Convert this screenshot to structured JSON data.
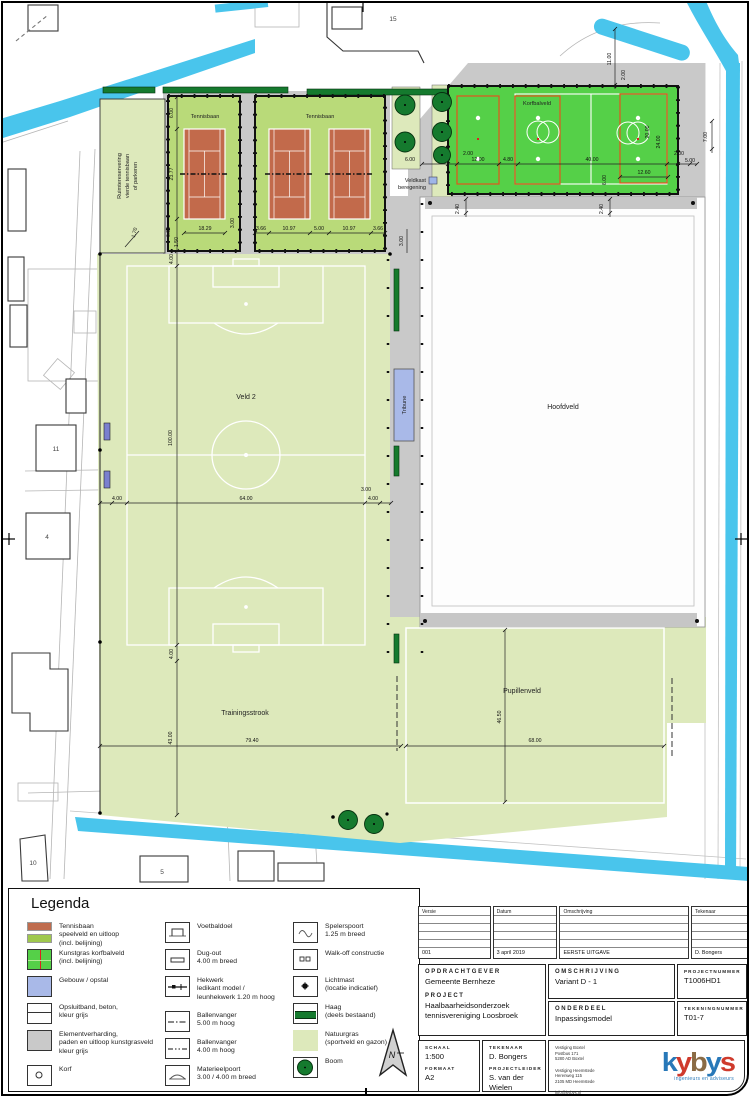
{
  "colors": {
    "water": "#49c5ec",
    "natuurgras": "#dde9bb",
    "kunstgras": "#55d048",
    "tennis_court": "#c26a4b",
    "tennis_uitloop": "#b9da79",
    "gebouw": "#a9b9e8",
    "verharding": "#c9c9c9",
    "haag": "#157a2e",
    "logo_blue": "#2878b8",
    "logo_red": "#cf3a2c",
    "logo_brown": "#8a6b45"
  },
  "plan": {
    "labels": {
      "tennis1": "Tennisbaan",
      "tennis2": "Tennisbaan",
      "korfbal": "Korfbalveld",
      "veld2": "Veld 2",
      "hoofdveld": "Hoofdveld",
      "training": "Trainingsstrook",
      "pupillen": "Pupillenveld",
      "tribune": "Tribune",
      "veldkast1": "Veldkast",
      "veldkast2": "beregening",
      "reserve1": "Ruimtereservering",
      "reserve2": "vierde tennisbaan",
      "reserve3": "of parkeren",
      "p15": "15",
      "p11": "11",
      "p4": "4",
      "p10": "10",
      "p5": "5"
    },
    "dims": {
      "t_top6": "6.00",
      "t_h": "23.77",
      "t_b6": "6.00",
      "t_150": "1.50",
      "t_300": "3.00",
      "t_w1": "18.29",
      "t_366a": "3.66",
      "t_1097a": "10.97",
      "t_500": "5.00",
      "t_1097b": "10.97",
      "t_366b": "3.66",
      "t_170": "1.70",
      "v_top4": "4.00",
      "v_100": "100.00",
      "v_bot4": "4.00",
      "v_l4": "4.00",
      "v_64": "64.00",
      "v_r4": "4.00",
      "v_300": "3.00",
      "tr_43": "43.00",
      "tr_794": "79.40",
      "pu_465": "46.50",
      "pu_68": "68.00",
      "k_6l": "6.00",
      "k_2a": "2.00",
      "k_12": "12.00",
      "k_48": "4.80",
      "k_40": "40.00",
      "k_2b": "2.00",
      "k_5": "5.00",
      "k_20": "20.00",
      "k_24": "24.00",
      "k_126": "12.60",
      "k_6b": "6.00",
      "k_11": "11.00",
      "k_2c": "2.00",
      "k_7": "7.00",
      "k_24a": "2.40",
      "k_24b": "2.40",
      "s_300": "3.00"
    }
  },
  "legend": {
    "title": "Legenda",
    "col1": [
      {
        "label": "Tennisbaan\nspeelveld en uitloop\n(incl. belijning)"
      },
      {
        "label": "Kunstgras korfbalveld\n(incl. belijning)"
      },
      {
        "label": "Gebouw / opstal"
      },
      {
        "label": "Opsluitband, beton,\nkleur grijs"
      },
      {
        "label": "Elementverharding,\npaden en uitloop kunstgrasveld\nkleur grijs"
      },
      {
        "label": "Korf"
      }
    ],
    "col2": [
      {
        "label": "Voetbaldoel"
      },
      {
        "label": "Dug-out\n4.00 m breed"
      },
      {
        "label": "Hekwerk\nledikant model /\nleunhekwerk 1.20 m hoog"
      },
      {
        "label": "Ballenvanger\n5.00 m hoog"
      },
      {
        "label": "Ballenvanger\n4.00 m hoog"
      },
      {
        "label": "Materieelpoort\n3.00 / 4.00 m breed"
      }
    ],
    "col3": [
      {
        "label": "Spelerspoort\n1.25 m breed"
      },
      {
        "label": "Walk-off constructie"
      },
      {
        "label": "Lichtmast\n(locatie indicatief)"
      },
      {
        "label": "Haag\n(deels bestaand)"
      },
      {
        "label": "Natuurgras\n(sportveld en gazon)"
      },
      {
        "label": "Boom"
      }
    ],
    "north": "N"
  },
  "titleblock": {
    "revisions": {
      "headers": [
        "Versie",
        "Datum",
        "Omschrijving",
        "Tekenaar"
      ],
      "entry": [
        "001",
        "3 april 2019",
        "EERSTE UITGAVE",
        "D. Bongers"
      ]
    },
    "opdrachtgever_label": "OPDRACHTGEVER",
    "opdrachtgever": "Gemeente Bernheze",
    "project_label": "PROJECT",
    "project": "Haalbaarheidsonderzoek\ntennisvereniging Loosbroek",
    "omschrijving_label": "OMSCHRIJVING",
    "omschrijving": "Variant D - 1",
    "onderdeel_label": "ONDERDEEL",
    "onderdeel": "Inpassingsmodel",
    "projectnummer_label": "PROJECTNUMMER",
    "projectnummer": "T1006HD1",
    "tekeningnummer_label": "TEKENINGNUMMER",
    "tekeningnummer": "T01-7",
    "schaal_label": "SCHAAL",
    "schaal": "1:500",
    "formaat_label": "FORMAAT",
    "formaat": "A2",
    "tekenaar_label": "TEKENAAR",
    "tekenaar": "D. Bongers",
    "projectleider_label": "PROJECTLEIDER",
    "projectleider": "S. van der Wielen",
    "address": "Vestiging Boxtel\nPostbus 171\n5280 AD Boxtel\n\nVestiging Heemstede\nHerenweg 115\n2105 MD Heemstede\n\ninfo@kybys.nl\nwww.kybys.nl",
    "logo": {
      "l1": "k",
      "l2": "y",
      "l3": "b",
      "l4": "y",
      "l5": "s",
      "tagline": "ingenieurs en adviseurs"
    }
  }
}
